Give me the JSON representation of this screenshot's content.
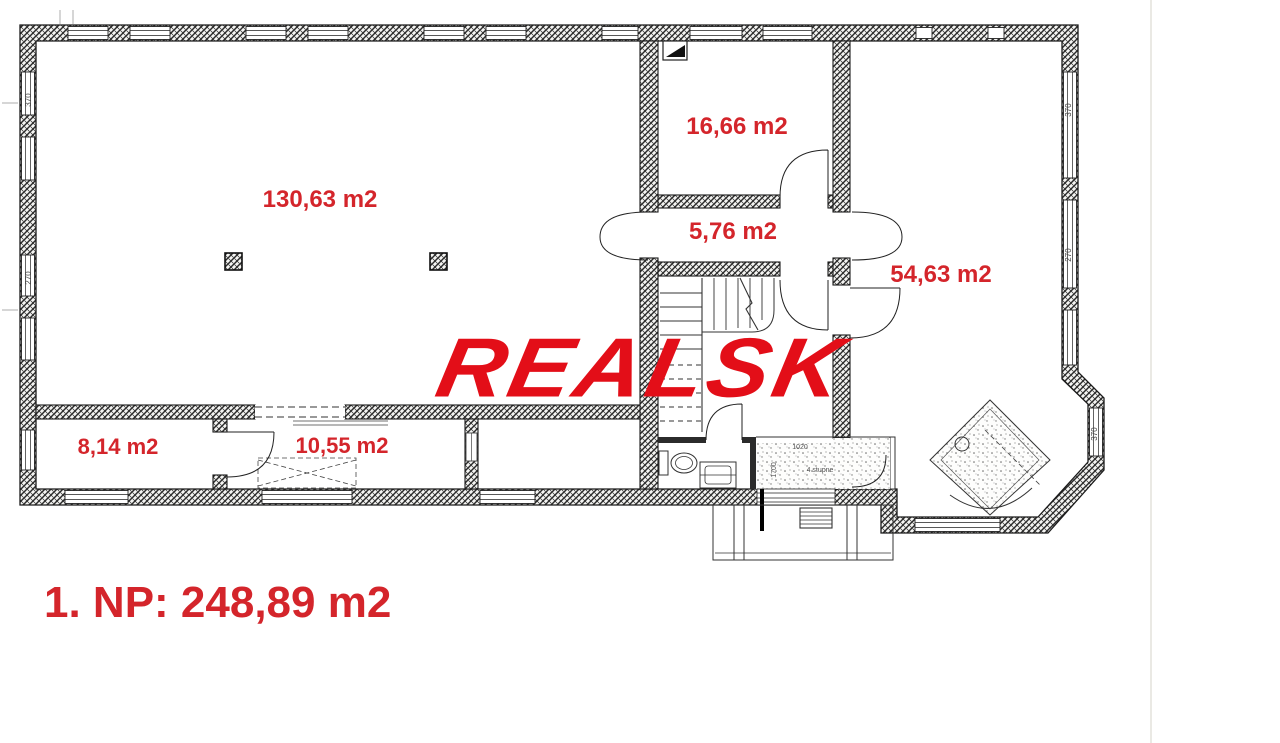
{
  "plan": {
    "watermark": "REALSK",
    "floor_title": "1. NP: 248,89 m2",
    "rooms": {
      "hall": "130,63 m2",
      "top_room": "16,66 m2",
      "corridor": "5,76 m2",
      "right_room": "54,63 m2",
      "small_left": "8,14 m2",
      "small_mid": "10,55 m2"
    },
    "dimensions": {
      "w370": "370",
      "w270": "270",
      "v1020": "1020",
      "v1700": "1700",
      "steps_note": "4 stupne"
    },
    "colors": {
      "label_red": "#d4252b",
      "logo_red": "#e30e18",
      "wall_ink": "#1a1a1a",
      "background": "#ffffff"
    }
  }
}
